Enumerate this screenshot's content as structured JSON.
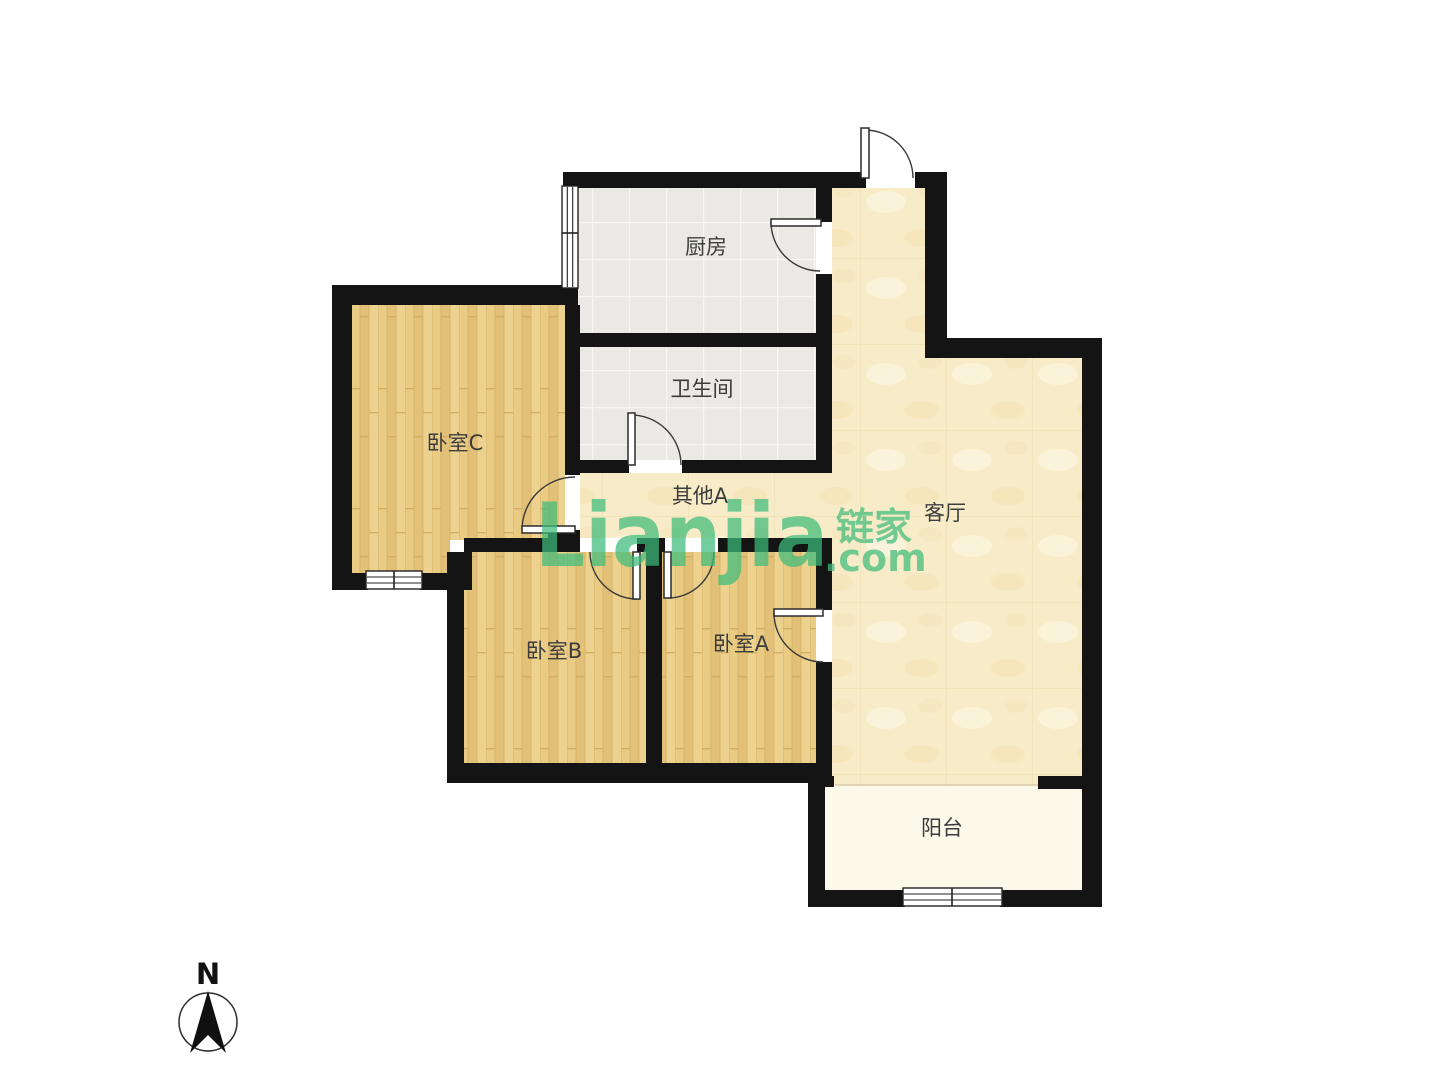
{
  "watermark": {
    "brand": "Lianjia",
    "brand_cn": "链家",
    "tld": ".com",
    "color": "#3EBC7B"
  },
  "compass": {
    "north_label": "N"
  },
  "rooms": {
    "kitchen": {
      "label": "厨房"
    },
    "bathroom": {
      "label": "卫生间"
    },
    "hallway": {
      "label": "其他A"
    },
    "living": {
      "label": "客厅"
    },
    "bedroom_c": {
      "label": "卧室C"
    },
    "bedroom_b": {
      "label": "卧室B"
    },
    "bedroom_a": {
      "label": "卧室A"
    },
    "balcony": {
      "label": "阳台"
    }
  },
  "colors": {
    "wall": "#141414",
    "wood_floor": "#E7C77E",
    "tile_floor": "#EBE9E5",
    "marble_floor": "#F8ECC8",
    "balcony_floor": "#FCF9EA",
    "watermark_green": "#3EBC7B"
  }
}
